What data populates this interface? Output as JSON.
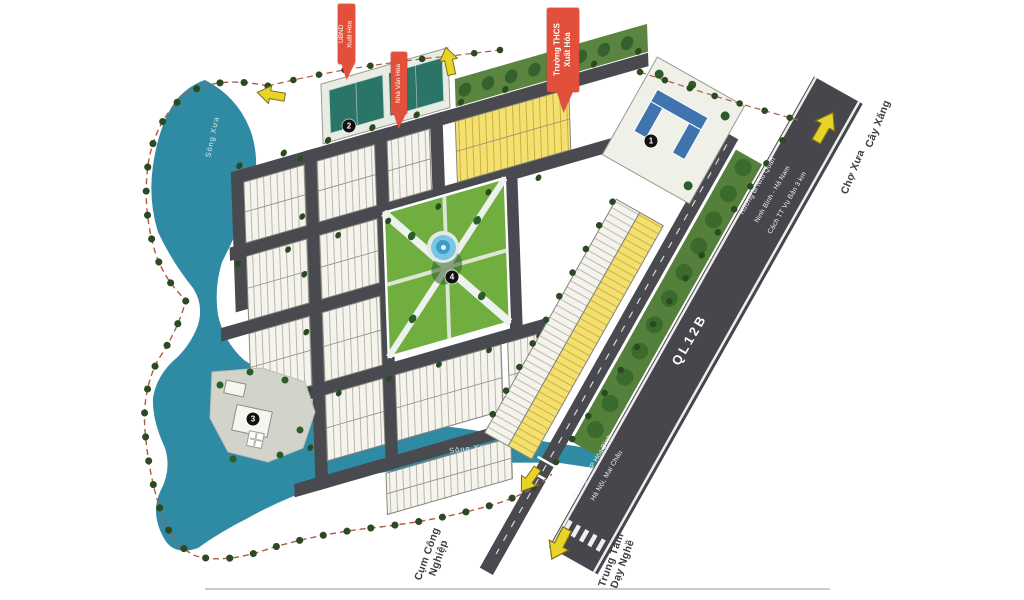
{
  "river": {
    "label_upper": "Sông Xưa",
    "label_lower": "Sông Xưa"
  },
  "highway": {
    "name": "QL12B",
    "direction_northeast": {
      "line1": "Hướng đi Nho Quan",
      "line2": "Ninh Bình - Hà Nam",
      "line3": "Cách TT Vụ Bản 3 km"
    },
    "direction_southwest": {
      "line1": "Hướng đi TP Hòa Bình",
      "line2": "Hà Nội, Mai Châu"
    }
  },
  "callouts": {
    "school": "Trường THCS\nXuất Hóa",
    "committee": "UBND\nXuất Hóa",
    "culture_house": "Nhà Văn Hóa"
  },
  "poi": {
    "market": "Chợ Xưa",
    "gas_station": "Cây Xăng",
    "industrial_cluster": "Cụm Công\nNghiệp",
    "vocational_center": "Trung Tâm\nDạy Nghề"
  },
  "markers": [
    {
      "value": "1"
    },
    {
      "value": "2"
    },
    {
      "value": "3"
    },
    {
      "value": "4"
    }
  ],
  "colors": {
    "river": "#2f8ba4",
    "road": "#494950",
    "highway": "#46464c",
    "lot_white": "#f4f3ec",
    "lot_yellow": "#f3e06e",
    "park_green": "#6fae3f",
    "tree_green": "#2c5d28",
    "callout_red": "#e2503c",
    "arrow_yellow": "#e8d429"
  }
}
